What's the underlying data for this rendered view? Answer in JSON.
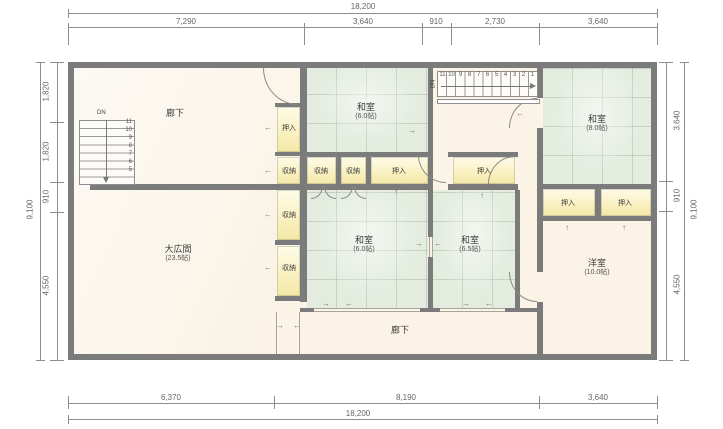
{
  "dimensions": {
    "top": {
      "total": "18,200",
      "segments": [
        "7,290",
        "3,640",
        "910",
        "2,730",
        "3,640"
      ]
    },
    "bottom": {
      "total": "18,200",
      "segments": [
        "6,370",
        "8,190",
        "3,640"
      ]
    },
    "left": {
      "total": "9,100",
      "segments": [
        "1,820",
        "1,820",
        "910",
        "4,550"
      ]
    },
    "right": {
      "total": "9,100",
      "segments": [
        "3,640",
        "910",
        "4,550"
      ]
    }
  },
  "rooms": {
    "corridor_top": {
      "name": "廊下"
    },
    "corridor_bottom": {
      "name": "廊下"
    },
    "washitsu_top": {
      "name": "和室",
      "size": "(6.0帖)"
    },
    "washitsu_top_right": {
      "name": "和室",
      "size": "(8.0帖)"
    },
    "washitsu_mid_left": {
      "name": "和室",
      "size": "(6.0帖)"
    },
    "washitsu_mid_right": {
      "name": "和室",
      "size": "(6.5帖)"
    },
    "great_hall": {
      "name": "大広間",
      "size": "(23.5帖)"
    },
    "western_room": {
      "name": "洋室",
      "size": "(10.0帖)"
    }
  },
  "closets": {
    "stack": [
      {
        "label": "押入"
      },
      {
        "label": "収納"
      },
      {
        "label": "収納"
      },
      {
        "label": "収納"
      }
    ],
    "row": [
      {
        "label": "収納"
      },
      {
        "label": "収納"
      },
      {
        "label": "押入"
      },
      {
        "label": "押入"
      }
    ],
    "right_pair": [
      {
        "label": "押入"
      },
      {
        "label": "押入"
      }
    ]
  },
  "stairs": {
    "left": {
      "dn": "DN",
      "steps": [
        "11",
        "10",
        "9",
        "8",
        "7",
        "6",
        "5"
      ]
    },
    "top": {
      "dn": "DN",
      "steps": [
        "11",
        "10",
        "9",
        "8",
        "7",
        "6",
        "5",
        "4",
        "3",
        "2",
        "1"
      ]
    }
  },
  "icons": {
    "arrow_up": "↑",
    "arrow_down": "↓",
    "arrow_left": "←",
    "arrow_right": "→"
  },
  "colors": {
    "wall": "#7b7b7b",
    "floor": "#faf3e6",
    "tatami": "#e3ecdf",
    "closet": "#f9f0bf",
    "dimension_text": "#666666"
  }
}
